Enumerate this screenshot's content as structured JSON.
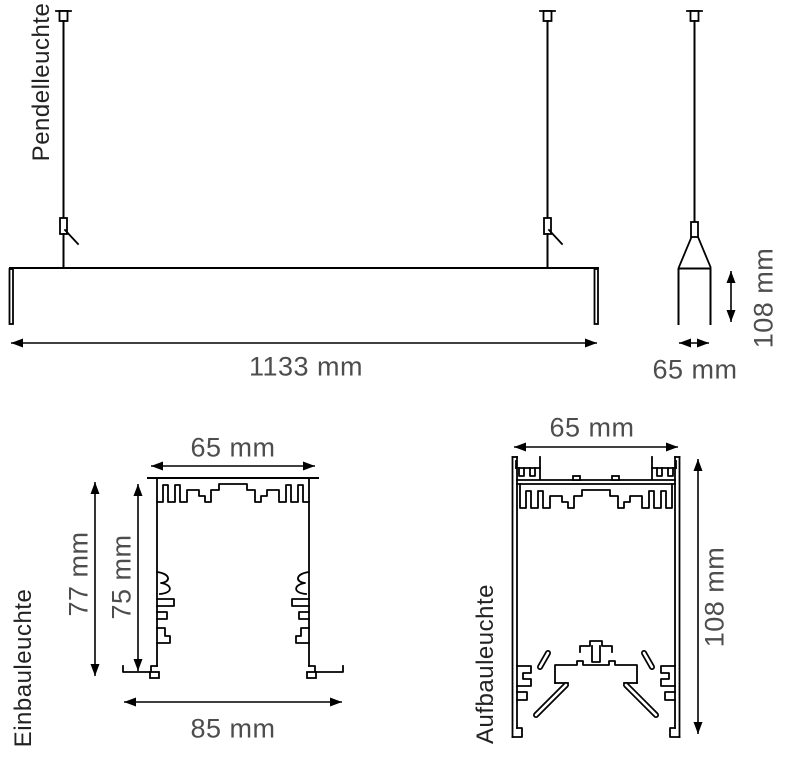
{
  "title": "Luminaire dimension drawing",
  "colors": {
    "background": "#ffffff",
    "line": "#000000",
    "dimension_text": "#4d4d4d",
    "label_text": "#222222"
  },
  "sections": {
    "pendant": {
      "label": "Pendelleuchte",
      "length": "1133 mm",
      "profile_width": "65 mm",
      "profile_height": "108 mm"
    },
    "recessed": {
      "label": "Einbauleuchte",
      "top_width": "65 mm",
      "overall_height": "77 mm",
      "recess_height": "75 mm",
      "bottom_width": "85 mm"
    },
    "surface": {
      "label": "Aufbauleuchte",
      "width": "65 mm",
      "height": "108 mm"
    }
  }
}
